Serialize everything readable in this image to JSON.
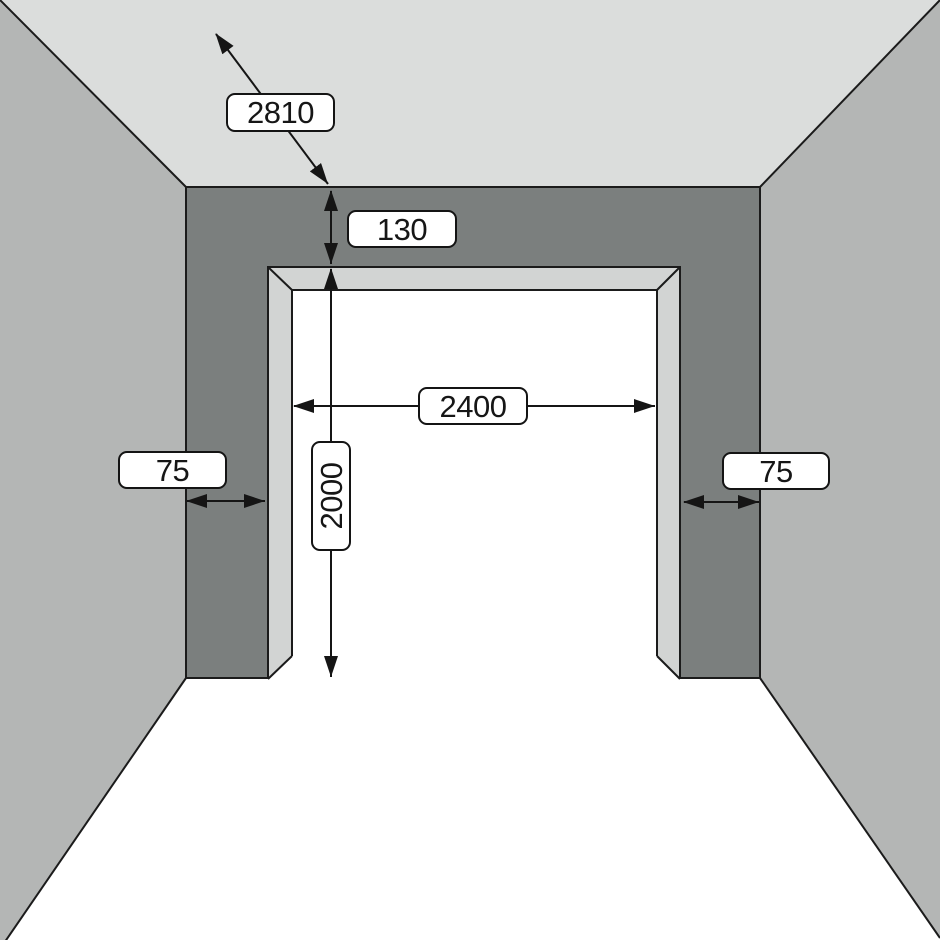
{
  "diagram": {
    "title": "garage-door-opening-clearance-diagram",
    "labels": {
      "depth": "2810",
      "headroom": "130",
      "opening_width": "2400",
      "opening_height": "2000",
      "side_room_left": "75",
      "side_room_right": "75"
    },
    "palette": {
      "ceiling": "#dbdddc",
      "side_walls": "#b4b6b5",
      "front_wall": "#7b7f7e",
      "opening_reveal": "#d2d4d3",
      "floor": "#ffffff",
      "line": "#1b1b1b",
      "label_background": "#ffffff",
      "label_border": "#141414"
    }
  }
}
